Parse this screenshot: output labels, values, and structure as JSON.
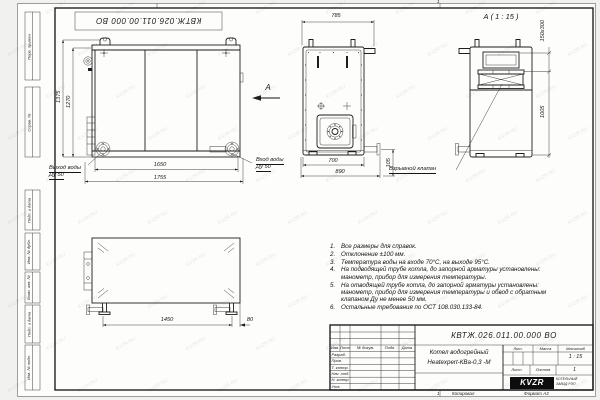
{
  "watermark": "KVZR.RU",
  "sheet": {
    "stamp_doc_number": "КВТЖ.026.011.00.000 ВО",
    "fold_mark": "1",
    "kopiroval": "Копировал",
    "format": "Формат А3"
  },
  "left_margin": {
    "fields": [
      "Перв. примен.",
      "Справ. №",
      "Подп. и дата",
      "Инв. № дубл.",
      "Взам. инв. №",
      "Подп. и дата",
      "Инв. № подл."
    ]
  },
  "front_view": {
    "dim_height_outer": "1375",
    "dim_height_inner": "1270",
    "dim_width_inner": "1650",
    "dim_width_outer": "1755",
    "outlet_line1": "Выход воды",
    "outlet_line2": "Ду 50",
    "inlet_line1": "Вход воды",
    "inlet_line2": "Ду 50",
    "view_letter": "А"
  },
  "side_view": {
    "dim_top": "785",
    "dim_width_inner": "700",
    "dim_width_outer": "890",
    "dim_pipe": "105"
  },
  "detail_view": {
    "title": "А ( 1 : 15 )",
    "dim_valve": "150x300",
    "dim_height": "1005",
    "valve_label": "Взрывной клапан"
  },
  "bottom_view": {
    "dim_length": "1450",
    "dim_offset": "80"
  },
  "notes": {
    "items": [
      {
        "num": "1.",
        "text": "Все размеры для справок."
      },
      {
        "num": "2.",
        "text": "Отклонение ±100 мм."
      },
      {
        "num": "3.",
        "text": "Температура воды на входе 70°С, на выходе 95°С."
      },
      {
        "num": "4.",
        "text": "На подводящей трубе котла, до запорной арматуры установлены:\nманометр, прибор для измерения температуры."
      },
      {
        "num": "5.",
        "text": "На отводящей трубе котла, до запорной арматуры установлены:\nманометр, прибор для измерения температуры и обвод с обратным\nклапаном Ду не менее 50 мм."
      },
      {
        "num": "6.",
        "text": "Остальные требования по ОСТ 108.030.133-84."
      }
    ]
  },
  "title_block": {
    "doc_number": "КВТЖ.026.011.00.000 ВО",
    "name_line1": "Котел водогрейный",
    "name_line2": "Heatexpert-КВа-0,3 -М",
    "header_cells": [
      "Изм.",
      "Лист",
      "№ докум.",
      "Подп.",
      "Дата"
    ],
    "rows": [
      "Разраб.",
      "Пров.",
      "Т. контр.",
      "Нач. отд.",
      "Н. контр.",
      "Утв."
    ],
    "lit_label": "Лит.",
    "mass_label": "Масса",
    "scale_label": "Масштаб",
    "scale_value": "1 : 15",
    "sheet_label": "Лист",
    "sheets_label": "Листов",
    "sheets_value": "1",
    "logo_text": "KVZR",
    "logo_sub1": "КОТЕЛЬНЫЙ",
    "logo_sub2": "ЗАВОД РЭП"
  }
}
